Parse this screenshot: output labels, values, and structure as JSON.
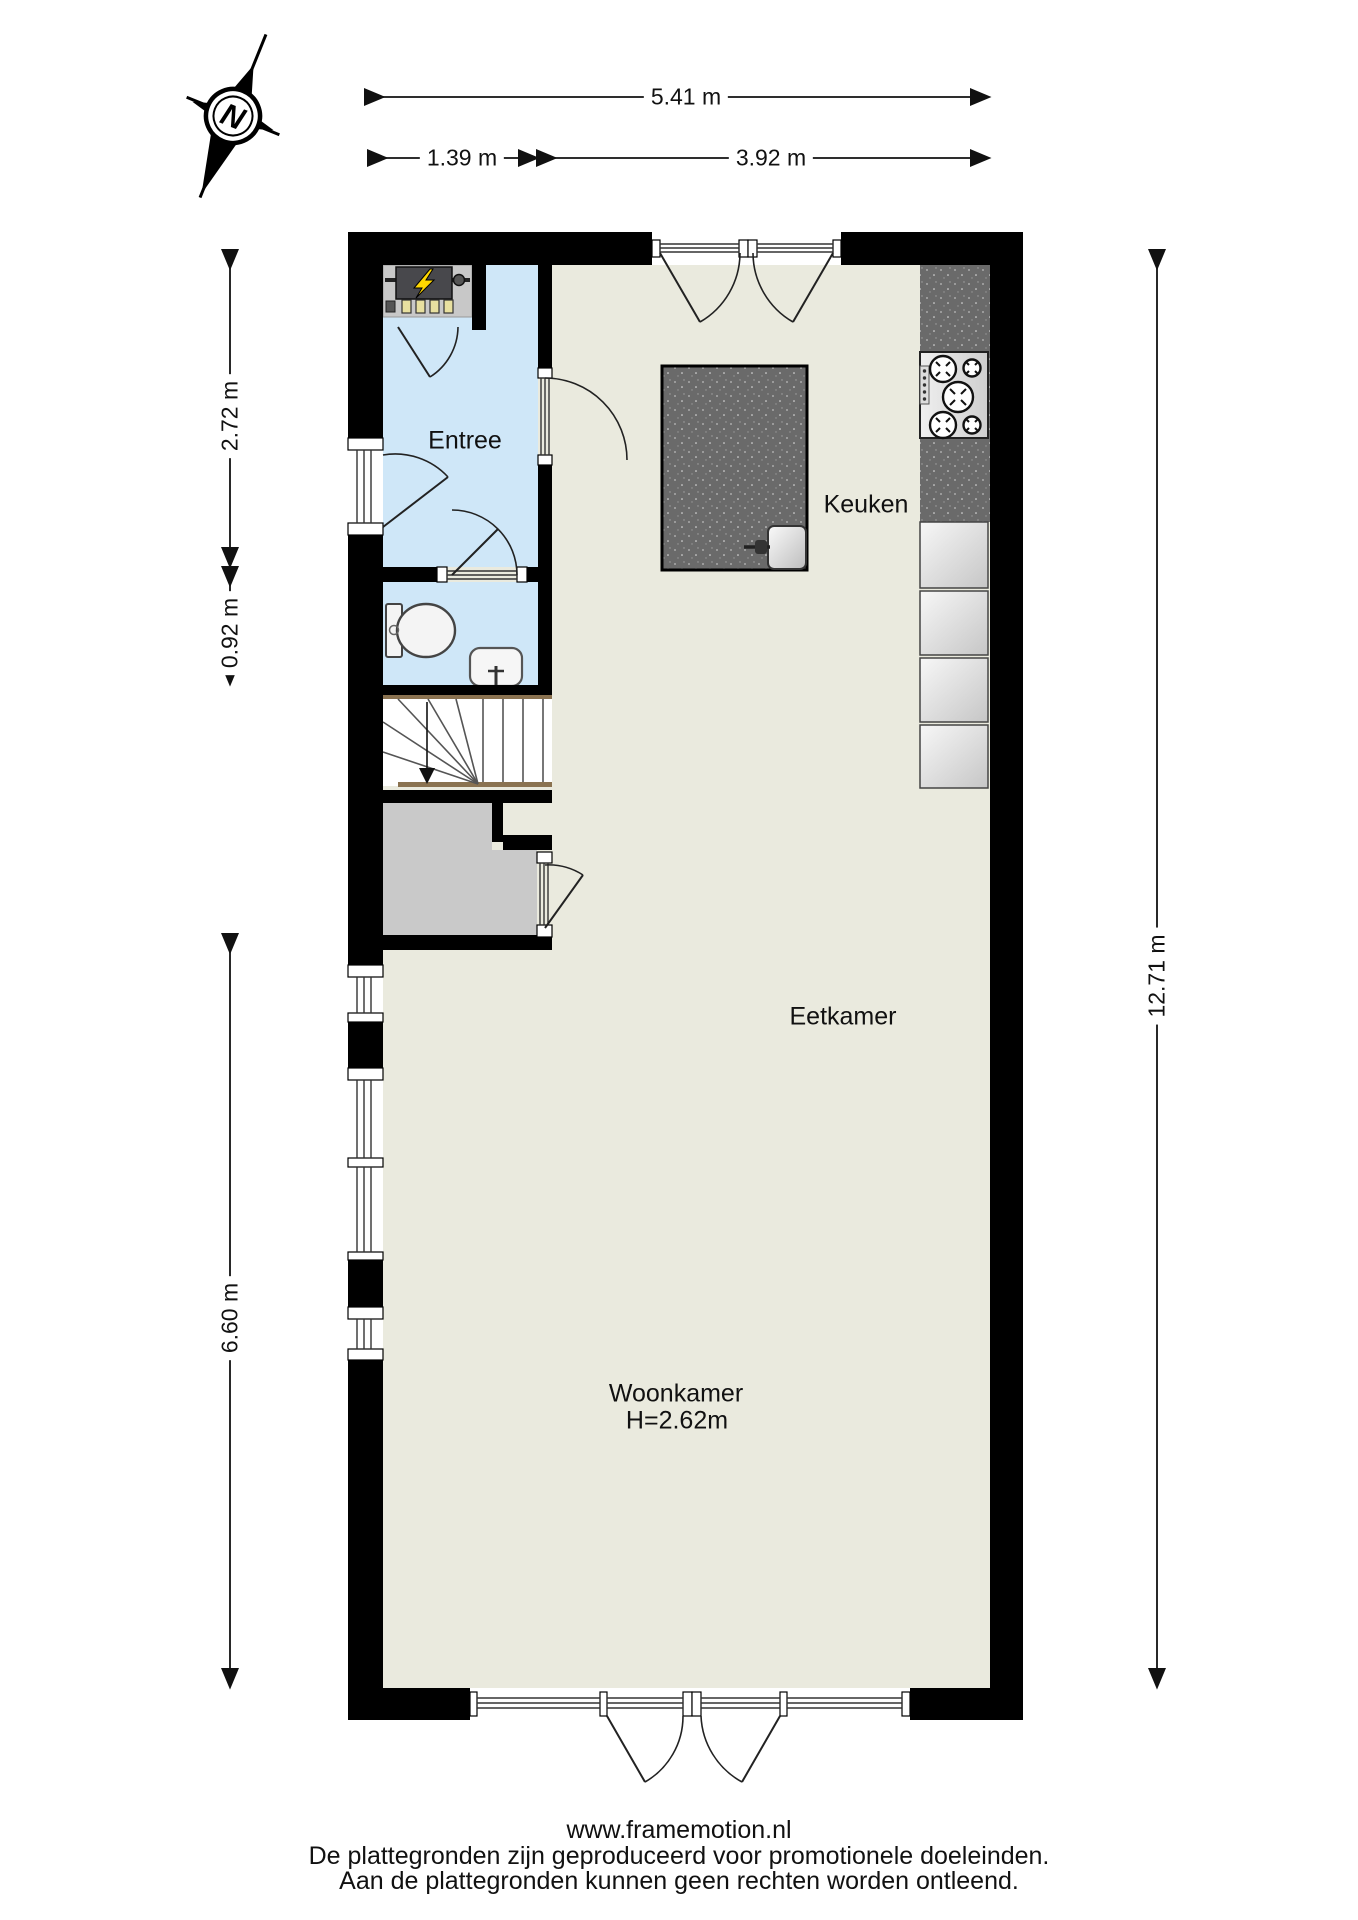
{
  "compass": {
    "label": "N"
  },
  "dimensions": {
    "top_total": "5.41 m",
    "top_left": "1.39 m",
    "top_right": "3.92 m",
    "left_upper": "2.72 m",
    "left_mid": "0.92 m",
    "left_lower": "6.60 m",
    "right_total": "12.71 m"
  },
  "rooms": {
    "entree": "Entree",
    "keuken": "Keuken",
    "eetkamer": "Eetkamer",
    "woonkamer": "Woonkamer",
    "woonkamer_height": "H=2.62m"
  },
  "footer": {
    "website": "www.framemotion.nl",
    "line1": "De plattegronden zijn geproduceerd voor promotionele doeleinden.",
    "line2": "Aan de plattegronden kunnen geen rechten worden ontleend."
  },
  "colors": {
    "wall": "#000000",
    "floor": "#eaeade",
    "wet_room": "#cfe7f8",
    "counter": "#6a6a6a",
    "closet": "#c9c9c9",
    "stair_stringer": "#8a7250",
    "bolt": "#ffd700"
  }
}
